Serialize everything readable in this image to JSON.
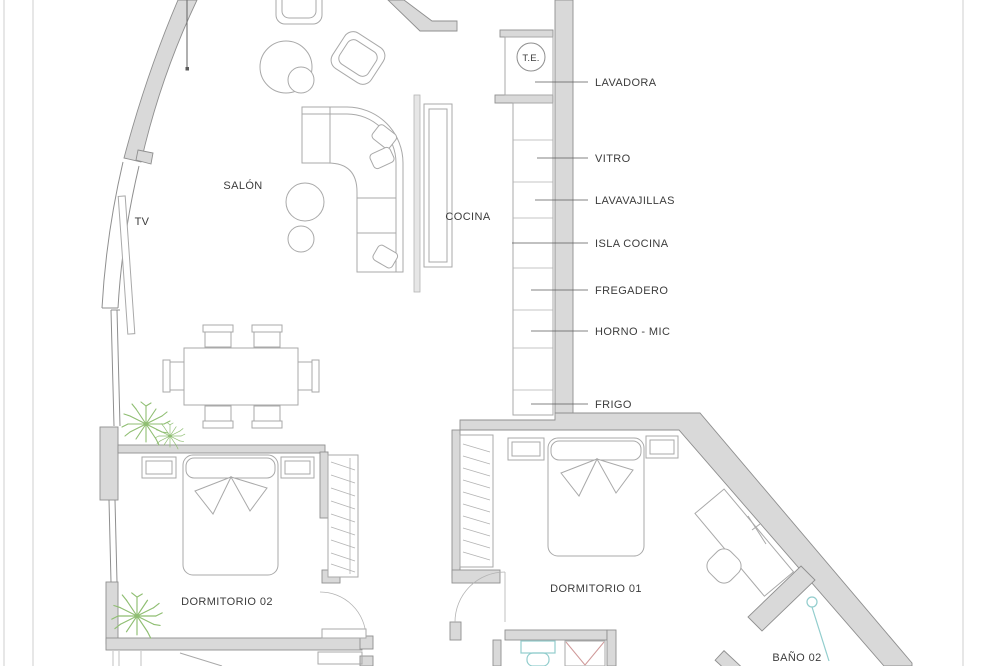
{
  "rooms": {
    "salon": "SALÓN",
    "tv": "TV",
    "cocina": "COCINA",
    "dormitorio_02": "DORMITORIO 02",
    "dormitorio_01": "DORMITORIO 01",
    "bano_02": "BAÑO 02",
    "electrical_panel": "T.E."
  },
  "kitchen_callouts": [
    "LAVADORA",
    "VITRO",
    "LAVAVAJILLAS",
    "ISLA COCINA",
    "FREGADERO",
    "HORNO - MIC",
    "FRIGO"
  ],
  "colors": {
    "wall": "#d9d9d9",
    "wallstroke": "#8f8f8f",
    "line": "#b3b3b3",
    "furn": "#a9a9a9",
    "leader": "#5a5a5a",
    "text": "#3c3c3c",
    "plant": "#8fbe72",
    "aqua": "#92cdcd",
    "red": "#d09a9a",
    "boundary": "#cfcfcf"
  }
}
